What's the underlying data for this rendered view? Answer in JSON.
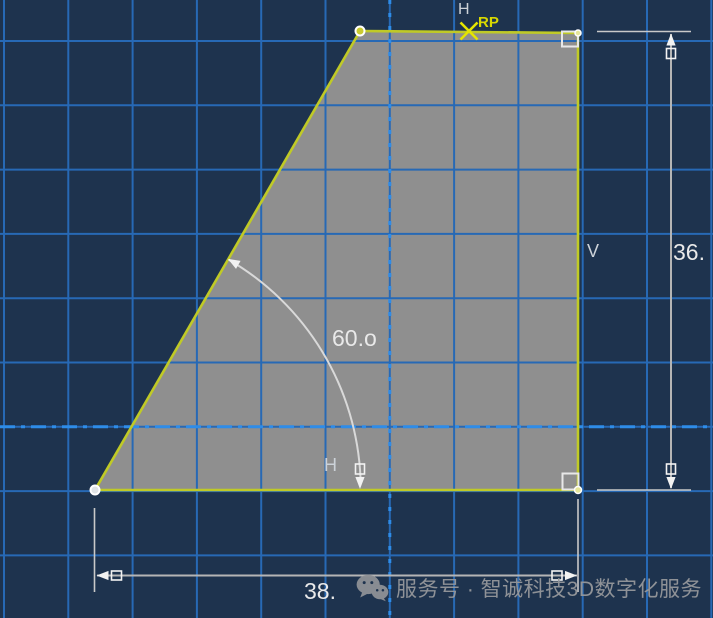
{
  "app": {
    "name": "CAD sketch viewport"
  },
  "constraints": {
    "top_h": "H",
    "bottom_h": "H",
    "right_v": "V"
  },
  "reference_point": {
    "label": "RP"
  },
  "dimensions": {
    "angle": "60.o",
    "height": "36.",
    "width": "38."
  },
  "watermark": {
    "text": "服务号 · 智诚科技3D数字化服务",
    "icon": "wechat-icon"
  },
  "colors": {
    "background": "#1e334e",
    "grid": "#2769b5",
    "axis_dashed": "#2e8ce8",
    "shape_fill": "#8f8f8f",
    "shape_edge": "#c0ca26",
    "dim_line": "#b5b5b5",
    "dim_arrow": "#f2f2f2",
    "arc": "#d9d9d9",
    "marker_stroke": "#ffffff",
    "marker_fill": "#e6e69a",
    "rp_cross": "#e5e500",
    "constraint_box": "#e8e8e8"
  },
  "scene": {
    "size": {
      "w": 713,
      "h": 618
    },
    "grid": {
      "x0": 4,
      "y0": 41,
      "step": 64.3
    },
    "axis": {
      "x": 389.8,
      "y": 426.8
    },
    "shape_points": [
      [
        95,
        490
      ],
      [
        578,
        490
      ],
      [
        578,
        33
      ],
      [
        360,
        31
      ]
    ]
  }
}
